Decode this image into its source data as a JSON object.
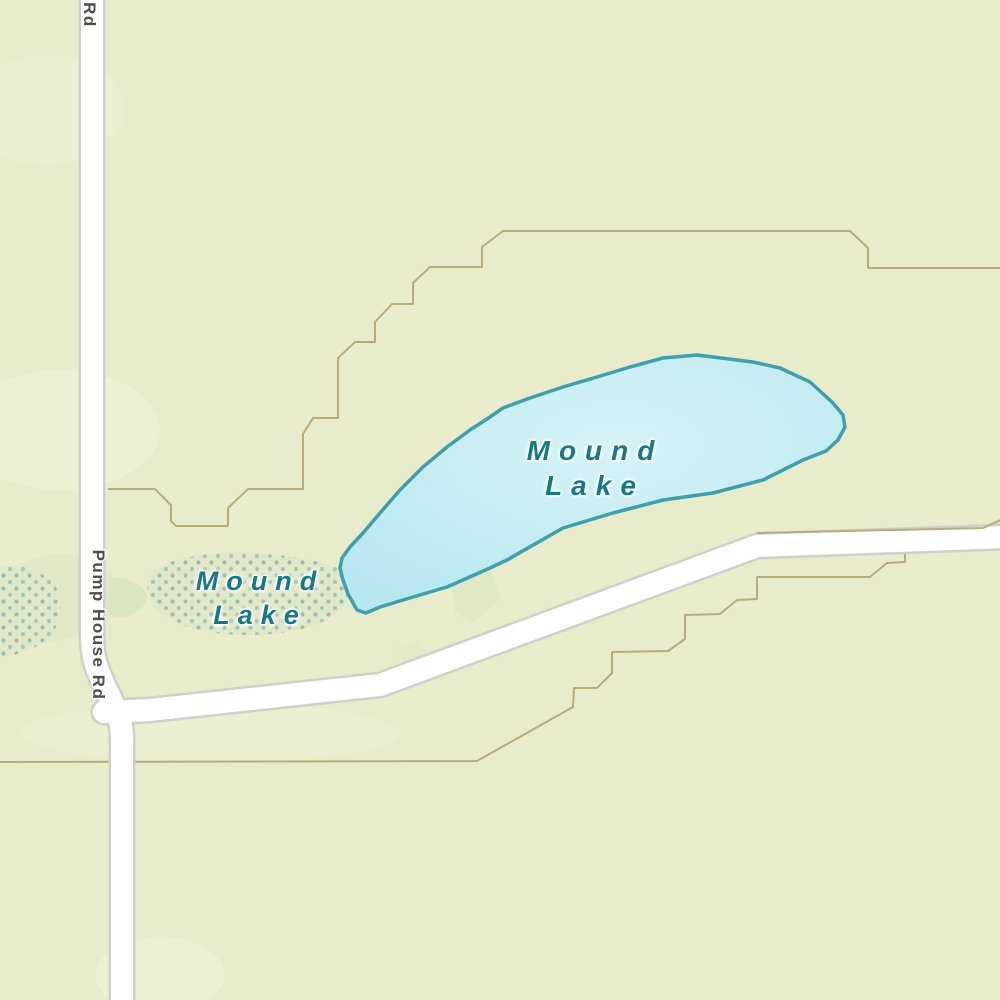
{
  "map": {
    "labels": {
      "lake": {
        "line1": "Mound",
        "line2": "Lake"
      },
      "lake_west": {
        "line1": "Mound",
        "line2": "Lake"
      },
      "road": "Pump House Rd",
      "road_fragment_top": "Rd"
    },
    "colors": {
      "land": "#e8ecca",
      "land_light": "#f1f4da",
      "vegetation": "#d9e5c0",
      "wetland_fill": "#e0e8c6",
      "wetland_dot": "#79b1b7",
      "lake_fill": "#b7e7ef",
      "lake_fill_light": "#d6f3f7",
      "lake_stroke": "#3e9fae",
      "road_fill": "#ffffff",
      "road_casing": "#d0d0c8",
      "boundary": "#b9ac7c"
    }
  }
}
